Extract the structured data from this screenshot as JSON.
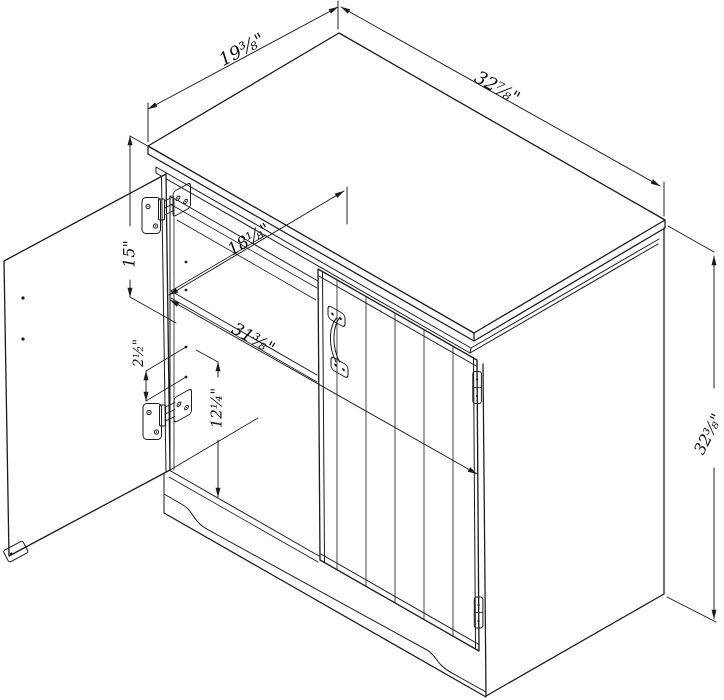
{
  "drawing": {
    "title": "Two-door storage cabinet — isometric dimension drawing",
    "background": "#ffffff",
    "line_color": "#1a1a1a",
    "dimensions": {
      "top_depth": {
        "label": "19⅜\"",
        "inches": 19.375
      },
      "top_width": {
        "label": "32⅞\"",
        "inches": 32.875
      },
      "overall_height": {
        "label": "32⅜\"",
        "inches": 32.375
      },
      "upper_opening": {
        "label": "15\"",
        "inches": 15
      },
      "shelf_hole_spacing": {
        "label": "2½\"",
        "inches": 2.5
      },
      "lower_opening": {
        "label": "12¼\"",
        "inches": 12.25
      },
      "interior_depth": {
        "label": "18⅛\"",
        "inches": 18.125
      },
      "interior_width": {
        "label": "31⅜\"",
        "inches": 31.375
      }
    }
  }
}
